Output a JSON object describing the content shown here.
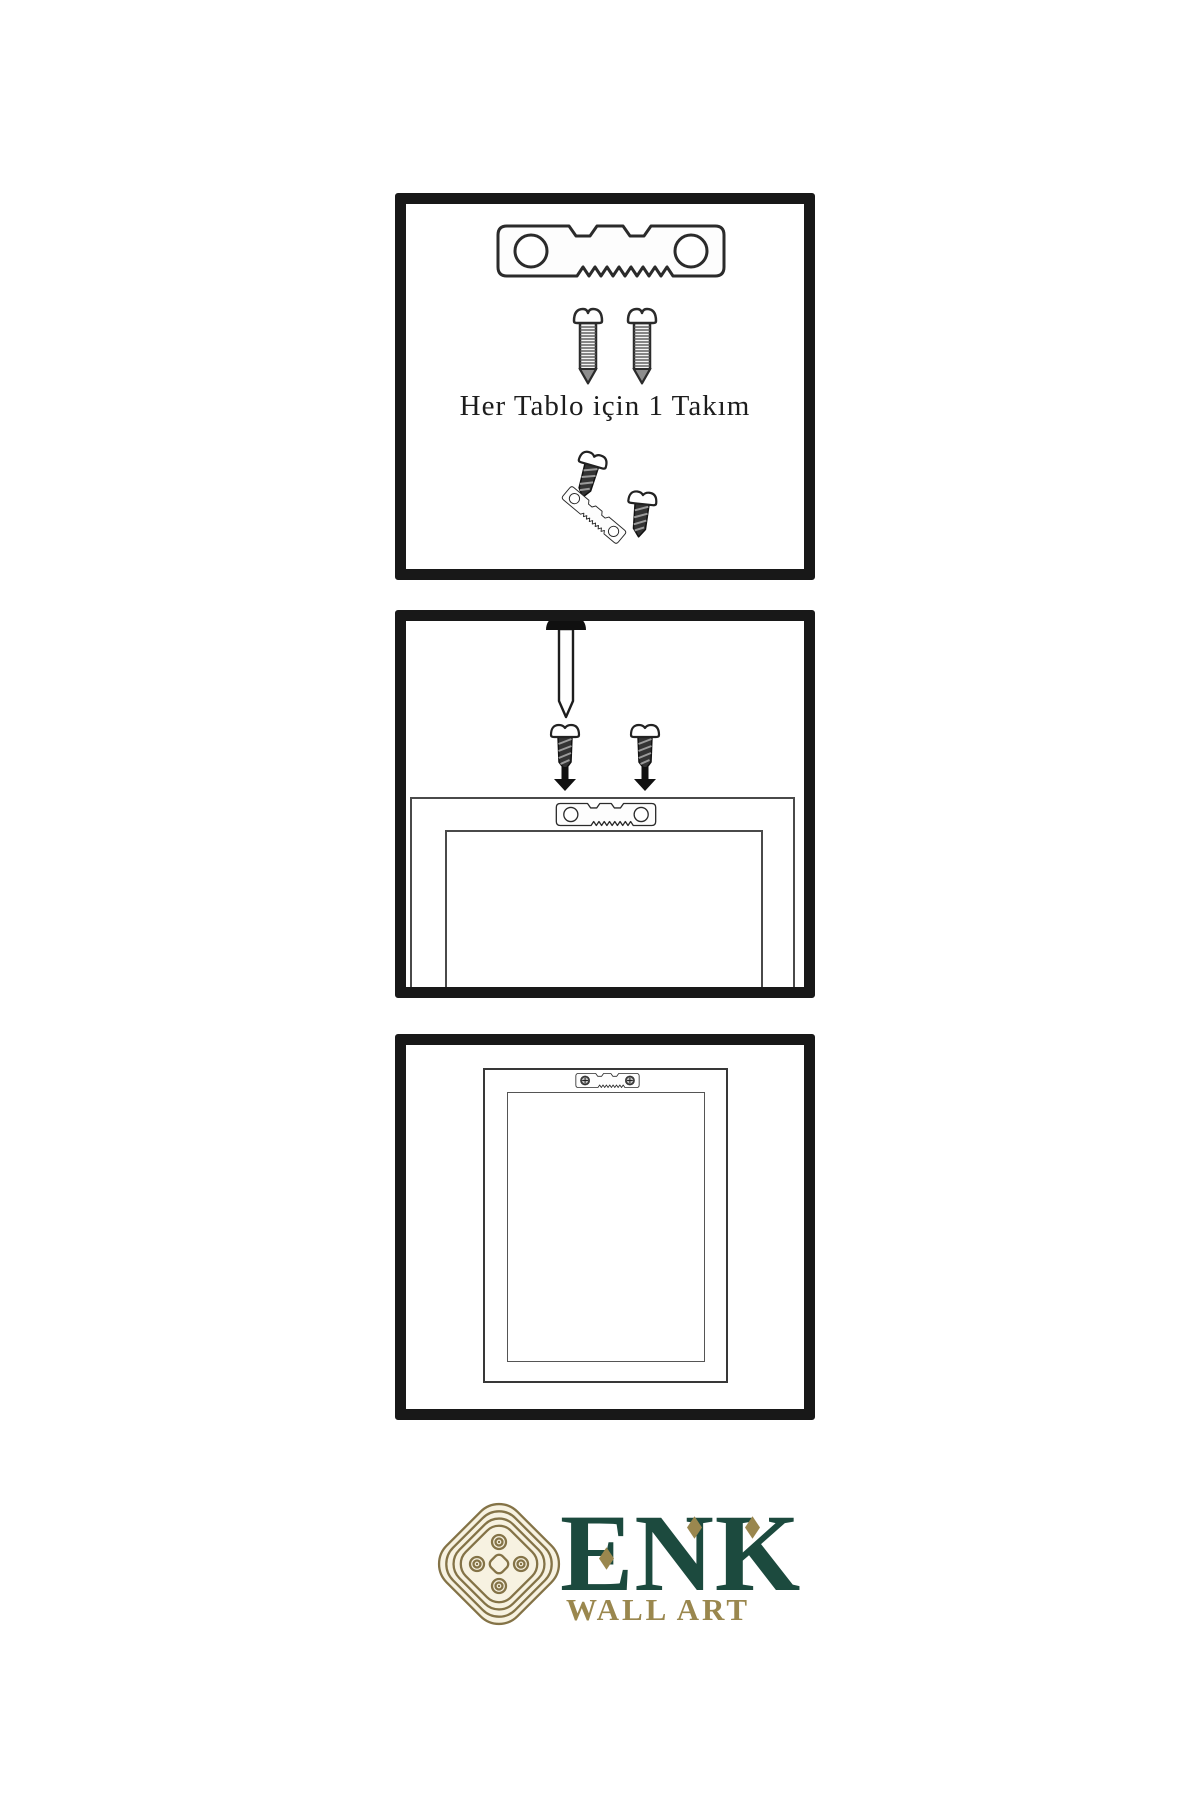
{
  "step1": {
    "caption": "Her Tablo için 1 Takım"
  },
  "brand": {
    "name": "ENK",
    "subtitle": "WALL ART"
  },
  "theme": {
    "green": "#1c4a3e",
    "gold": "#9a874e",
    "knot": "#847347",
    "ink": "#161616"
  },
  "icons": [
    "sawtooth-hanger-icon",
    "screw-icon",
    "mounting-screw-icon",
    "nail-icon",
    "arrow-down-icon",
    "frame-back-icon",
    "frame-front-icon",
    "knot-logo-icon",
    "diamond-accent-icon"
  ]
}
